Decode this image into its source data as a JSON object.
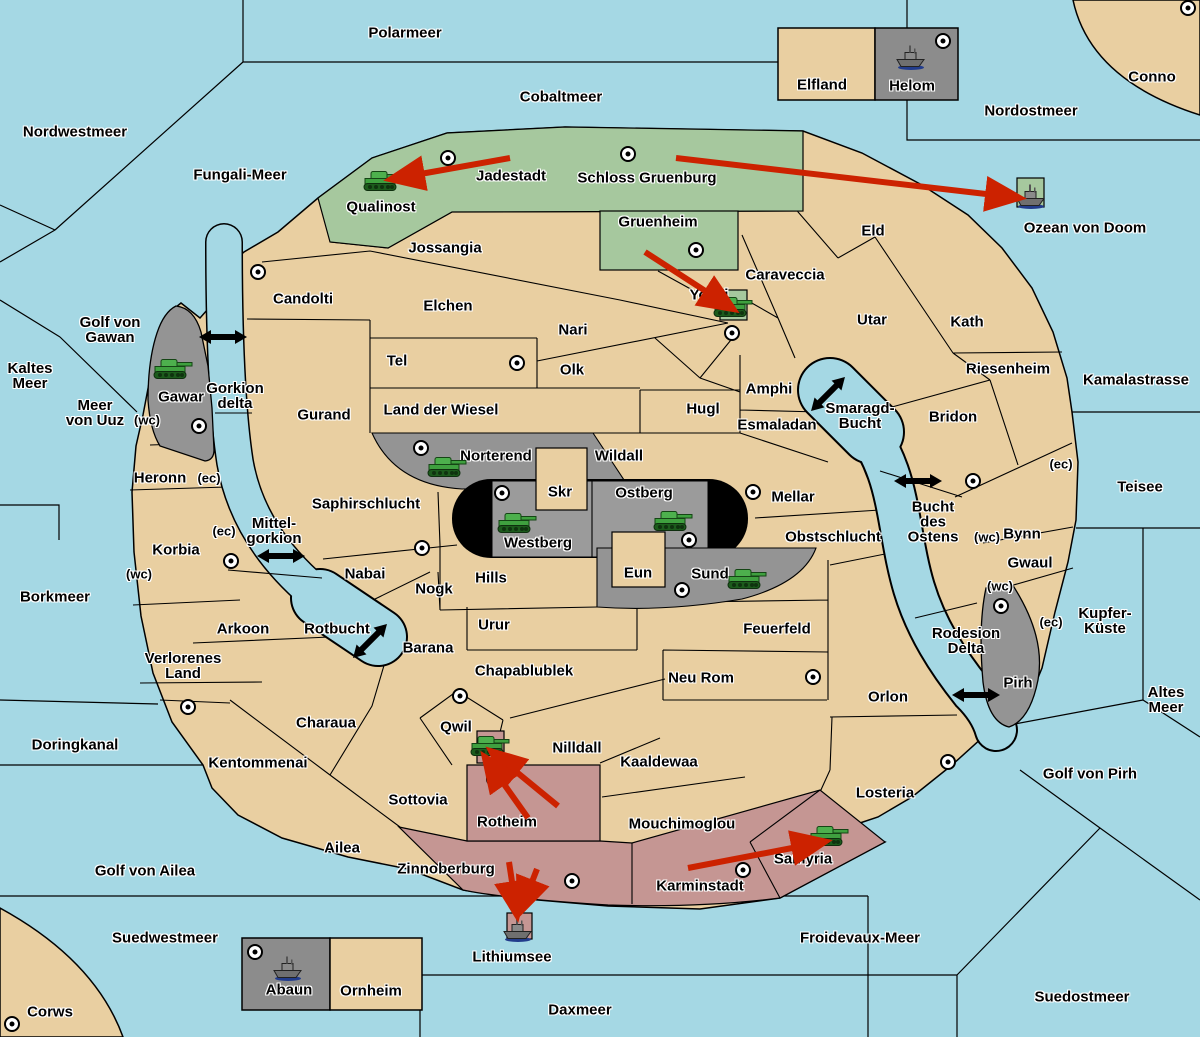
{
  "map": {
    "width": 1200,
    "height": 1037
  },
  "colors": {
    "sea": "#A5D8E4",
    "land": "#E9CFA1",
    "green": "#A6C89E",
    "gray": "#949494",
    "pink": "#C59693",
    "black": "#000000",
    "arrow_red": "#CC2200",
    "marker_fill": "#FFFFFF",
    "border": "#000000"
  },
  "labels": [
    {
      "id": "polarmeer",
      "text": "Polarmeer",
      "x": 405,
      "y": 33
    },
    {
      "id": "cobaltmeer",
      "text": "Cobaltmeer",
      "x": 561,
      "y": 97
    },
    {
      "id": "nordwestmeer",
      "text": "Nordwestmeer",
      "x": 75,
      "y": 132
    },
    {
      "id": "fungali-meer",
      "text": "Fungali-Meer",
      "x": 240,
      "y": 175
    },
    {
      "id": "nordostmeer",
      "text": "Nordostmeer",
      "x": 1031,
      "y": 111
    },
    {
      "id": "conno",
      "text": "Conno",
      "x": 1152,
      "y": 77
    },
    {
      "id": "elfland",
      "text": "Elfland",
      "x": 822,
      "y": 85
    },
    {
      "id": "helom",
      "text": "Helom",
      "x": 912,
      "y": 86
    },
    {
      "id": "ozean-von-doom",
      "text": "Ozean von Doom",
      "x": 1085,
      "y": 228
    },
    {
      "id": "qualinost",
      "text": "Qualinost",
      "x": 381,
      "y": 207
    },
    {
      "id": "jadestadt",
      "text": "Jadestadt",
      "x": 511,
      "y": 176
    },
    {
      "id": "schloss-gruenburg",
      "text": "Schloss Gruenburg",
      "x": 647,
      "y": 178
    },
    {
      "id": "jossangia",
      "text": "Jossangia",
      "x": 445,
      "y": 248
    },
    {
      "id": "gruenheim",
      "text": "Gruenheim",
      "x": 658,
      "y": 222
    },
    {
      "id": "caraveccia",
      "text": "Caraveccia",
      "x": 785,
      "y": 275
    },
    {
      "id": "yokai",
      "text": "Yokai",
      "x": 709,
      "y": 295
    },
    {
      "id": "eld",
      "text": "Eld",
      "x": 873,
      "y": 231
    },
    {
      "id": "utar",
      "text": "Utar",
      "x": 872,
      "y": 320
    },
    {
      "id": "kath",
      "text": "Kath",
      "x": 967,
      "y": 322
    },
    {
      "id": "riesenheim",
      "text": "Riesenheim",
      "x": 1008,
      "y": 369
    },
    {
      "id": "kamalastrasse",
      "text": "Kamalastrasse",
      "x": 1136,
      "y": 380
    },
    {
      "id": "candolti",
      "text": "Candolti",
      "x": 303,
      "y": 299
    },
    {
      "id": "elchen",
      "text": "Elchen",
      "x": 448,
      "y": 306
    },
    {
      "id": "nari",
      "text": "Nari",
      "x": 573,
      "y": 330
    },
    {
      "id": "tel",
      "text": "Tel",
      "x": 397,
      "y": 361
    },
    {
      "id": "olk",
      "text": "Olk",
      "x": 572,
      "y": 370
    },
    {
      "id": "golf-von-gawan",
      "text": "Golf von\nGawan",
      "x": 110,
      "y": 330
    },
    {
      "id": "kaltes-meer",
      "text": "Kaltes\nMeer",
      "x": 30,
      "y": 376
    },
    {
      "id": "meer-von-uuz",
      "text": "Meer\nvon Uuz",
      "x": 95,
      "y": 413
    },
    {
      "id": "gawar",
      "text": "Gawar",
      "x": 181,
      "y": 397
    },
    {
      "id": "gorkion-delta",
      "text": "Gorkion\ndelta",
      "x": 235,
      "y": 396
    },
    {
      "id": "gurand",
      "text": "Gurand",
      "x": 324,
      "y": 415
    },
    {
      "id": "land-der-wiesel",
      "text": "Land der Wiesel",
      "x": 441,
      "y": 410
    },
    {
      "id": "hugl",
      "text": "Hugl",
      "x": 703,
      "y": 409
    },
    {
      "id": "amphi",
      "text": "Amphi",
      "x": 769,
      "y": 389
    },
    {
      "id": "esmaladan",
      "text": "Esmaladan",
      "x": 777,
      "y": 425
    },
    {
      "id": "smaragd-bucht",
      "text": "Smaragd-\nBucht",
      "x": 860,
      "y": 416
    },
    {
      "id": "bridon",
      "text": "Bridon",
      "x": 953,
      "y": 417
    },
    {
      "id": "heronn",
      "text": "Heronn",
      "x": 160,
      "y": 478
    },
    {
      "id": "norterend",
      "text": "Norterend",
      "x": 496,
      "y": 456
    },
    {
      "id": "wildall",
      "text": "Wildall",
      "x": 619,
      "y": 456
    },
    {
      "id": "skr",
      "text": "Skr",
      "x": 560,
      "y": 492
    },
    {
      "id": "ostberg",
      "text": "Ostberg",
      "x": 644,
      "y": 493
    },
    {
      "id": "mellar",
      "text": "Mellar",
      "x": 793,
      "y": 497
    },
    {
      "id": "bucht-des-ostens",
      "text": "Bucht\ndes\nOstens",
      "x": 933,
      "y": 522
    },
    {
      "id": "teisee",
      "text": "Teisee",
      "x": 1140,
      "y": 487
    },
    {
      "id": "saphirschlucht",
      "text": "Saphirschlucht",
      "x": 366,
      "y": 504
    },
    {
      "id": "westberg",
      "text": "Westberg",
      "x": 538,
      "y": 543
    },
    {
      "id": "obstschlucht",
      "text": "Obstschlucht",
      "x": 833,
      "y": 537
    },
    {
      "id": "bynn",
      "text": "Bynn",
      "x": 1022,
      "y": 534
    },
    {
      "id": "gwaul",
      "text": "Gwaul",
      "x": 1030,
      "y": 563
    },
    {
      "id": "korbia",
      "text": "Korbia",
      "x": 176,
      "y": 550
    },
    {
      "id": "mittel-gorkion",
      "text": "Mittel-\ngorkion",
      "x": 274,
      "y": 531
    },
    {
      "id": "borkmeer",
      "text": "Borkmeer",
      "x": 55,
      "y": 597
    },
    {
      "id": "nabai",
      "text": "Nabai",
      "x": 365,
      "y": 574
    },
    {
      "id": "nogk",
      "text": "Nogk",
      "x": 434,
      "y": 589
    },
    {
      "id": "hills",
      "text": "Hills",
      "x": 491,
      "y": 578
    },
    {
      "id": "eun",
      "text": "Eun",
      "x": 638,
      "y": 573
    },
    {
      "id": "sund",
      "text": "Sund",
      "x": 710,
      "y": 574
    },
    {
      "id": "kupfer-kueste",
      "text": "Kupfer-\nKüste",
      "x": 1105,
      "y": 621
    },
    {
      "id": "urur",
      "text": "Urur",
      "x": 494,
      "y": 625
    },
    {
      "id": "feuerfeld",
      "text": "Feuerfeld",
      "x": 777,
      "y": 629
    },
    {
      "id": "rotbucht",
      "text": "Rotbucht",
      "x": 337,
      "y": 629
    },
    {
      "id": "barana",
      "text": "Barana",
      "x": 428,
      "y": 648
    },
    {
      "id": "arkoon",
      "text": "Arkoon",
      "x": 243,
      "y": 629
    },
    {
      "id": "verlorenes-land",
      "text": "Verlorenes\nLand",
      "x": 183,
      "y": 666
    },
    {
      "id": "rodesion-delta",
      "text": "Rodesion\nDelta",
      "x": 966,
      "y": 641
    },
    {
      "id": "pirh",
      "text": "Pirh",
      "x": 1018,
      "y": 683
    },
    {
      "id": "altes-meer",
      "text": "Altes\nMeer",
      "x": 1166,
      "y": 700
    },
    {
      "id": "chapablublek",
      "text": "Chapablublek",
      "x": 524,
      "y": 671
    },
    {
      "id": "neu-rom",
      "text": "Neu Rom",
      "x": 701,
      "y": 678
    },
    {
      "id": "orlon",
      "text": "Orlon",
      "x": 888,
      "y": 697
    },
    {
      "id": "doringkanal",
      "text": "Doringkanal",
      "x": 75,
      "y": 745
    },
    {
      "id": "charaua",
      "text": "Charaua",
      "x": 326,
      "y": 723
    },
    {
      "id": "kentommenai",
      "text": "Kentommenai",
      "x": 258,
      "y": 763
    },
    {
      "id": "qwil",
      "text": "Qwil",
      "x": 456,
      "y": 727
    },
    {
      "id": "nilldall",
      "text": "Nilldall",
      "x": 577,
      "y": 748
    },
    {
      "id": "kaaldewaa",
      "text": "Kaaldewaa",
      "x": 659,
      "y": 762
    },
    {
      "id": "golf-von-pirh",
      "text": "Golf von Pirh",
      "x": 1090,
      "y": 774
    },
    {
      "id": "losteria",
      "text": "Losteria",
      "x": 885,
      "y": 793
    },
    {
      "id": "sottovia",
      "text": "Sottovia",
      "x": 418,
      "y": 800
    },
    {
      "id": "rotheim",
      "text": "Rotheim",
      "x": 507,
      "y": 822
    },
    {
      "id": "mouchimoglou",
      "text": "Mouchimoglou",
      "x": 682,
      "y": 824
    },
    {
      "id": "ailea",
      "text": "Ailea",
      "x": 342,
      "y": 848
    },
    {
      "id": "golf-von-ailea",
      "text": "Golf von Ailea",
      "x": 145,
      "y": 871
    },
    {
      "id": "zinnoberburg",
      "text": "Zinnoberburg",
      "x": 446,
      "y": 869
    },
    {
      "id": "karminstadt",
      "text": "Karminstadt",
      "x": 700,
      "y": 886
    },
    {
      "id": "samyria",
      "text": "Samyria",
      "x": 803,
      "y": 859
    },
    {
      "id": "suedwestmeer",
      "text": "Suedwestmeer",
      "x": 165,
      "y": 938
    },
    {
      "id": "lithiumsee",
      "text": "Lithiumsee",
      "x": 512,
      "y": 957
    },
    {
      "id": "froidevaux-meer",
      "text": "Froidevaux-Meer",
      "x": 860,
      "y": 938
    },
    {
      "id": "abaun",
      "text": "Abaun",
      "x": 289,
      "y": 990
    },
    {
      "id": "ornheim",
      "text": "Ornheim",
      "x": 371,
      "y": 991
    },
    {
      "id": "corws",
      "text": "Corws",
      "x": 50,
      "y": 1012
    },
    {
      "id": "daxmeer",
      "text": "Daxmeer",
      "x": 580,
      "y": 1010
    },
    {
      "id": "suedostmeer",
      "text": "Suedostmeer",
      "x": 1082,
      "y": 997
    },
    {
      "id": "wc-heronn",
      "text": "(wc)",
      "x": 147,
      "y": 420,
      "small": true
    },
    {
      "id": "ec-heronn",
      "text": "(ec)",
      "x": 209,
      "y": 478,
      "small": true
    },
    {
      "id": "ec-korbia",
      "text": "(ec)",
      "x": 224,
      "y": 531,
      "small": true
    },
    {
      "id": "wc-korbia",
      "text": "(wc)",
      "x": 139,
      "y": 574,
      "small": true
    },
    {
      "id": "ec-bynn",
      "text": "(ec)",
      "x": 1061,
      "y": 464,
      "small": true
    },
    {
      "id": "wc-bynn",
      "text": "(wc)",
      "x": 987,
      "y": 537,
      "small": true
    },
    {
      "id": "wc-gwaul",
      "text": "(wc)",
      "x": 1000,
      "y": 586,
      "small": true
    },
    {
      "id": "ec-pirh",
      "text": "(ec)",
      "x": 1051,
      "y": 622,
      "small": true
    }
  ],
  "city_markers": [
    [
      448,
      158
    ],
    [
      628,
      154
    ],
    [
      696,
      250
    ],
    [
      1188,
      8
    ],
    [
      943,
      41
    ],
    [
      258,
      272
    ],
    [
      732,
      333
    ],
    [
      517,
      363
    ],
    [
      421,
      448
    ],
    [
      502,
      493
    ],
    [
      689,
      540
    ],
    [
      682,
      590
    ],
    [
      753,
      492
    ],
    [
      199,
      426
    ],
    [
      231,
      561
    ],
    [
      422,
      548
    ],
    [
      188,
      707
    ],
    [
      460,
      696
    ],
    [
      494,
      779
    ],
    [
      572,
      881
    ],
    [
      743,
      870
    ],
    [
      813,
      677
    ],
    [
      948,
      762
    ],
    [
      973,
      481
    ],
    [
      1001,
      606
    ],
    [
      255,
      952
    ],
    [
      12,
      1024
    ]
  ],
  "units": {
    "tanks": [
      [
        383,
        184
      ],
      [
        173,
        372
      ],
      [
        447,
        470
      ],
      [
        517,
        526
      ],
      [
        673,
        524
      ],
      [
        747,
        582
      ],
      [
        733,
        310
      ],
      [
        490,
        749
      ],
      [
        829,
        839
      ]
    ],
    "ships": [
      [
        911,
        60
      ],
      [
        1031,
        199
      ],
      [
        518,
        932
      ],
      [
        288,
        971
      ]
    ]
  },
  "red_arrows": [
    {
      "from": [
        510,
        158
      ],
      "to": [
        398,
        178
      ]
    },
    {
      "from": [
        676,
        158
      ],
      "to": [
        1012,
        197
      ]
    },
    {
      "from": [
        645,
        252
      ],
      "to": [
        727,
        305
      ]
    },
    {
      "from": [
        558,
        806
      ],
      "to": [
        497,
        756
      ]
    },
    {
      "from": [
        528,
        818
      ],
      "to": [
        489,
        763
      ]
    },
    {
      "from": [
        509,
        862
      ],
      "to": [
        516,
        908
      ]
    },
    {
      "from": [
        537,
        869
      ],
      "to": [
        523,
        905
      ]
    },
    {
      "from": [
        688,
        868
      ],
      "to": [
        818,
        843
      ]
    }
  ],
  "strait_arrows": [
    {
      "x": 223,
      "y": 337,
      "angle": 0
    },
    {
      "x": 281,
      "y": 556,
      "angle": 0
    },
    {
      "x": 370,
      "y": 641,
      "angle": -45
    },
    {
      "x": 828,
      "y": 394,
      "angle": -45
    },
    {
      "x": 918,
      "y": 481,
      "angle": 0
    },
    {
      "x": 976,
      "y": 695,
      "angle": 0
    }
  ]
}
